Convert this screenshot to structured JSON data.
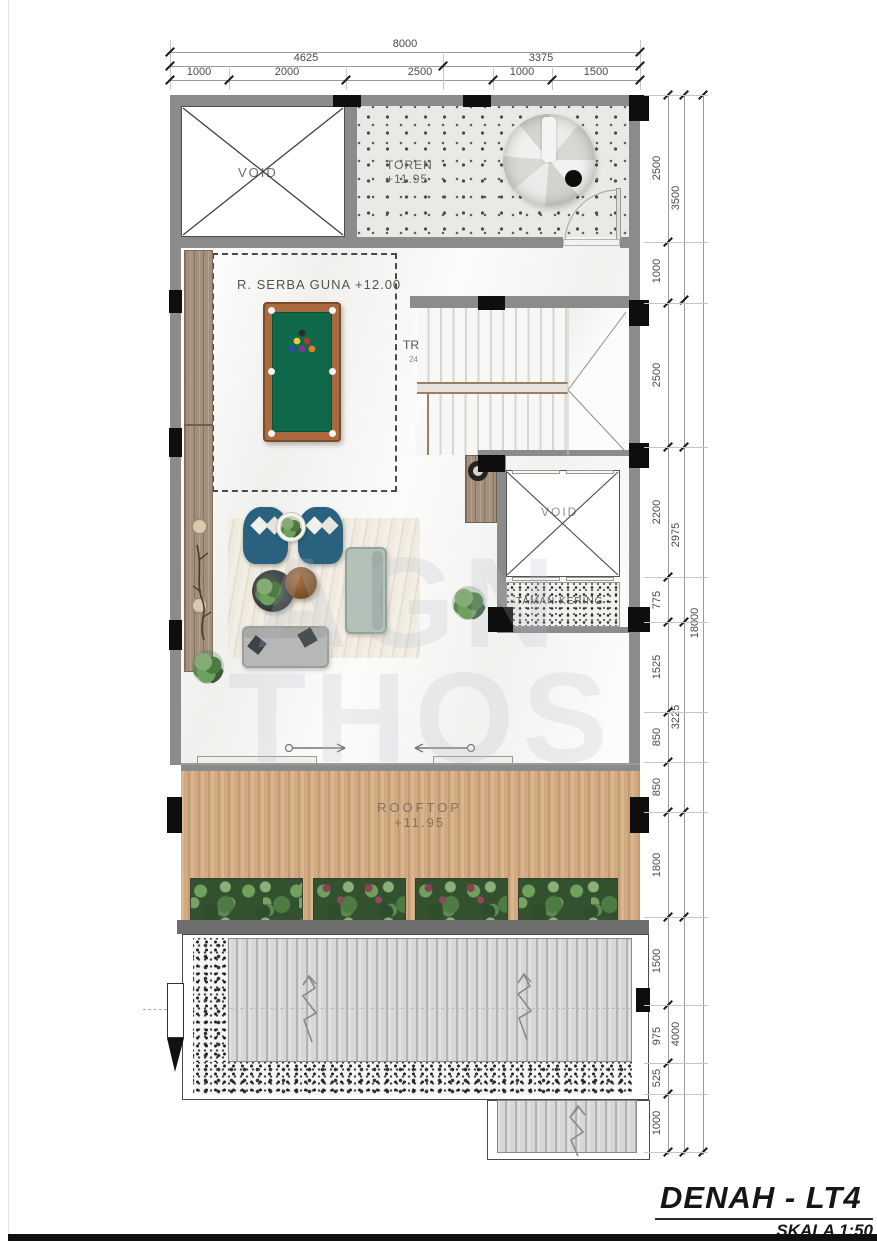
{
  "title_block": {
    "title": "DENAH - LT4",
    "scale": "SKALA 1:50"
  },
  "watermark": {
    "line1": "AGN",
    "line2": "THOS"
  },
  "dimensions": {
    "top": {
      "total": "8000",
      "groups": [
        "4625",
        "3375"
      ],
      "segments": [
        "1000",
        "2000",
        "2500",
        "1000",
        "1500"
      ]
    },
    "right": {
      "total": "18000",
      "groups": [
        "3500",
        "2975",
        "3225",
        "4000"
      ],
      "segments": [
        "2500",
        "1000",
        "2500",
        "2200",
        "775",
        "1525",
        "850",
        "850",
        "1800",
        "1500",
        "975",
        "525",
        "1000"
      ]
    }
  },
  "rooms": {
    "void_top": "VOID",
    "toren_name": "TOREN",
    "toren_level": "+11.95",
    "serba_guna": "R. SERBA GUNA +12.00",
    "stair_label": "TR",
    "stair_count": "24",
    "void_shaft": "VOID",
    "taman_kering": "TAMAN KERING",
    "rooftop_name": "ROOFTOP",
    "rooftop_level": "+11.95"
  }
}
